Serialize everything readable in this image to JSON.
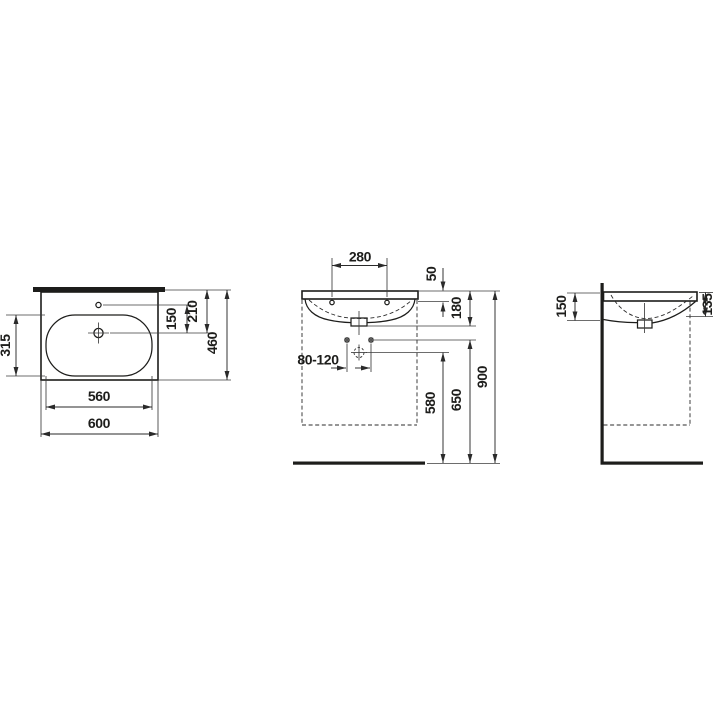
{
  "drawing": {
    "type": "technical-dimension-drawing",
    "subject": "washbasin",
    "background_color": "#ffffff",
    "line_color": "#1d1d1b",
    "units": "mm",
    "views": {
      "top": {
        "label": "top-view",
        "dims": {
          "overall_width": "600",
          "basin_width": "560",
          "basin_depth": "315",
          "overall_depth": "460",
          "overflow_to_tap": "150",
          "rear_to_tap": "210"
        }
      },
      "front": {
        "label": "front-view",
        "dims": {
          "tap_hole_spacing": "280",
          "rim_to_fixing_holes": "50",
          "body_height": "180",
          "supply_spacing": "80-120",
          "waste_outlet_height": "580",
          "supply_height": "650",
          "rim_height": "900"
        }
      },
      "side": {
        "label": "side-view",
        "dims": {
          "height_at_wall": "150",
          "height_at_front": "135"
        }
      }
    }
  }
}
